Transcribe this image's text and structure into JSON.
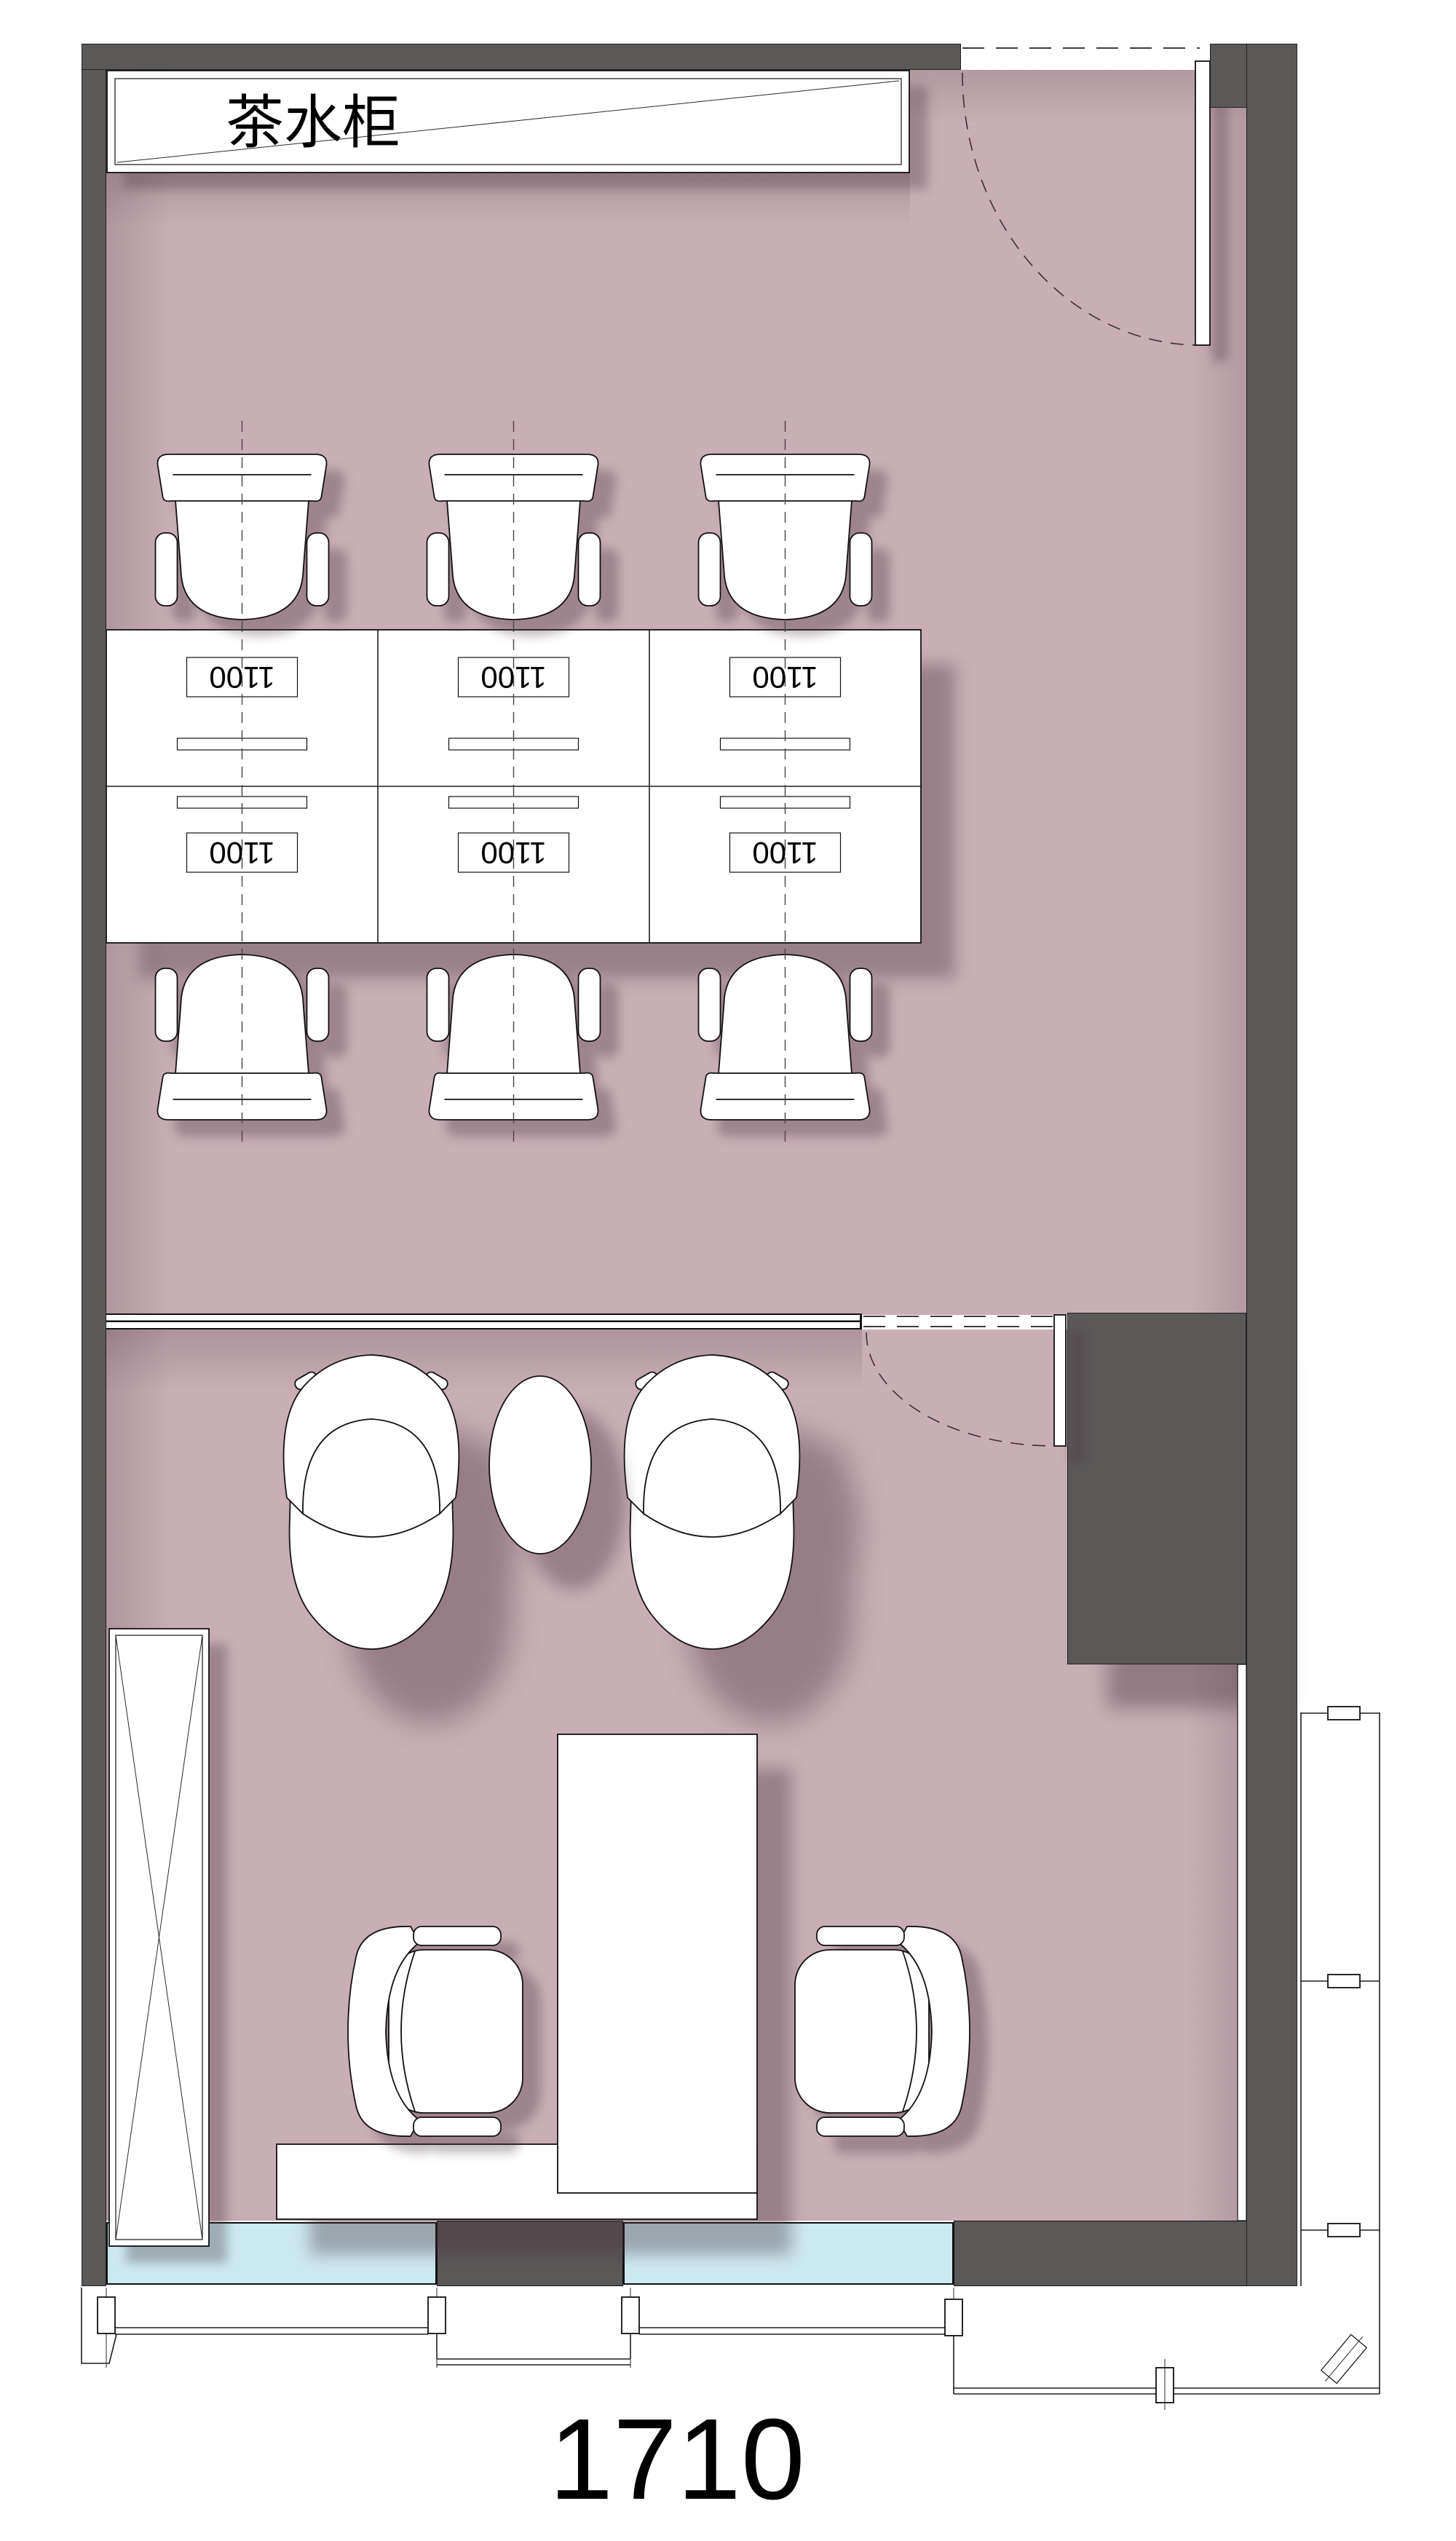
{
  "meta": {
    "room_number": "1710",
    "drawing_type": "office floor plan"
  },
  "cabinet": {
    "label": "茶水柜"
  },
  "workstations": {
    "rows": 2,
    "cols": 3,
    "desks": [
      {
        "label": "1100"
      },
      {
        "label": "1100"
      },
      {
        "label": "1100"
      },
      {
        "label": "1100"
      },
      {
        "label": "1100"
      },
      {
        "label": "1100"
      }
    ]
  },
  "colors": {
    "wall": "#5b5858",
    "floor": "#c9aeb5",
    "window_glass": "#cde9f0",
    "line": "#1e1e1e",
    "shadow": "rgba(70,48,57,0.38)",
    "paper": "#ffffff"
  }
}
